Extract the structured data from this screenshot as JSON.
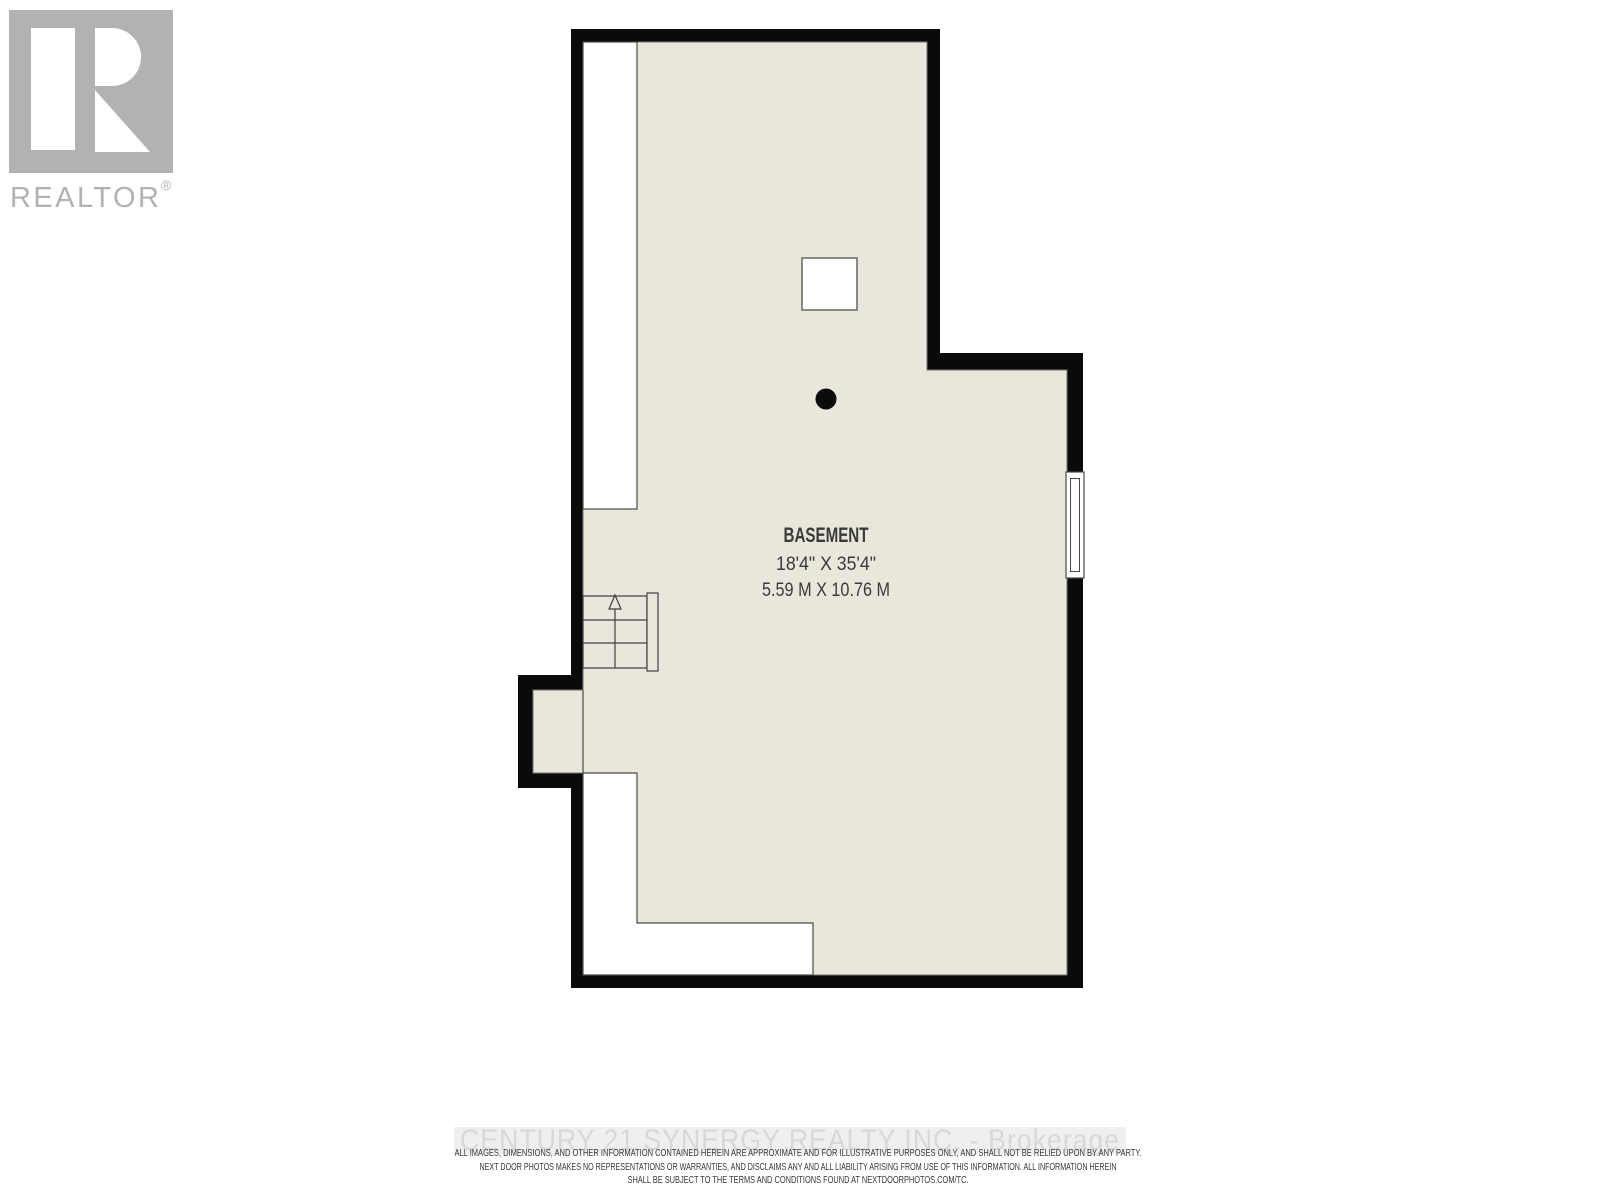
{
  "branding": {
    "wordmark": "REALTOR",
    "registered_symbol": "®"
  },
  "floorplan": {
    "room": {
      "name": "BASEMENT",
      "dimensions_imperial": "18'4\" X 35'4\"",
      "dimensions_metric": "5.59 M X 10.76 M"
    }
  },
  "footer": {
    "watermark": "CENTURY 21 SYNERGY REALTY INC. - Brokerage",
    "disclaimer_lines": [
      "ALL IMAGES, DIMENSIONS, AND OTHER INFORMATION CONTAINED HEREIN ARE APPROXIMATE AND FOR ILLUSTRATIVE PURPOSES ONLY, AND SHALL NOT BE RELIED UPON BY ANY PARTY.",
      "NEXT DOOR PHOTOS MAKES NO REPRESENTATIONS OR WARRANTIES, AND DISCLAIMS ANY AND ALL LIABILITY ARISING FROM USE OF THIS INFORMATION. ALL INFORMATION HEREIN",
      "SHALL BE SUBJECT TO THE TERMS AND CONDITIONS FOUND AT NEXTDOORPHOTOS.COM/TC."
    ]
  },
  "colors": {
    "wall_black": "#0a0a0a",
    "floor_beige": "#e9e7dc",
    "detail_line": "#4a4a46",
    "logo_gray": "#b3b1b1",
    "watermark_gray": "#d8d8d8",
    "label_text": "#3a3a38"
  }
}
